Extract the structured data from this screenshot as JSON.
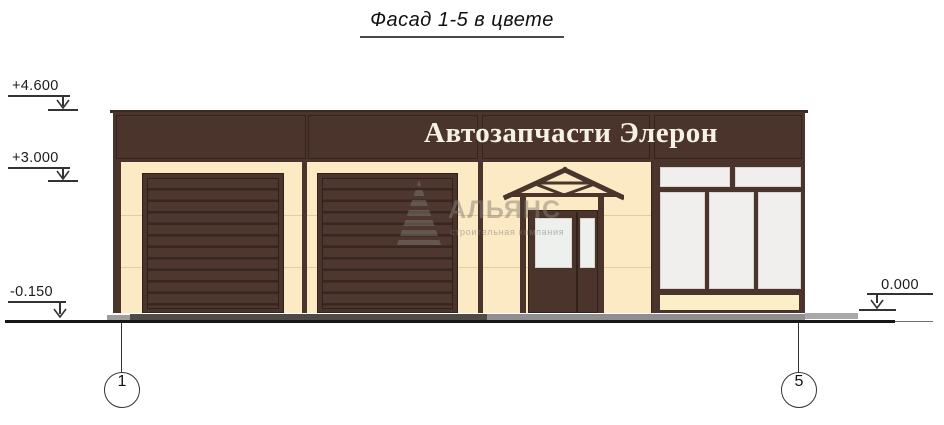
{
  "title": "Фасад 1-5 в цвете",
  "signboard": {
    "text": "Автозапчасти Элерон"
  },
  "elevation_marks": {
    "parapet": "+4.600",
    "signband_bottom": "+3.000",
    "ground_left": "-0.150",
    "ground_right": "0.000"
  },
  "axis_markers": {
    "left": "1",
    "right": "5"
  },
  "watermark": {
    "company": "АЛЬЯНС",
    "tagline": "строительная компания"
  },
  "colors": {
    "facade_brown": "#4a342c",
    "facade_brown_dark": "#31211b",
    "facade_cream": "#fbeac4",
    "spandrel_cream": "#fcefc8",
    "glass": "#f0efed",
    "sign_text": "#f6f1e3",
    "apron_dark": "#4e4a46",
    "apron_mid": "#8f8f8f",
    "apron_light": "#a8a8a8",
    "ground_line": "#161616",
    "annotation_line": "#333333"
  }
}
